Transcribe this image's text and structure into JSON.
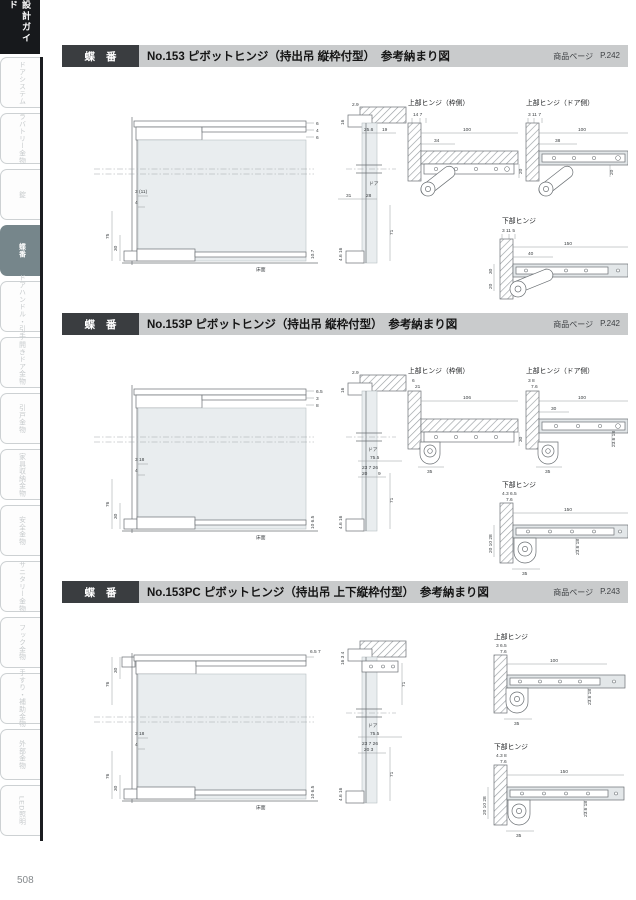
{
  "page": {
    "number": "508"
  },
  "sidebar": {
    "guide_tab": "設計ガイド",
    "tabs": [
      {
        "label": "ドアシステム",
        "active": false
      },
      {
        "label": "ラバトリー金物",
        "active": false
      },
      {
        "label": "錠",
        "active": false
      },
      {
        "label": "蝶番",
        "active": true
      },
      {
        "label": "ドアハンドル・引手",
        "active": false
      },
      {
        "label": "開きドア金物",
        "active": false
      },
      {
        "label": "引戸金物",
        "active": false
      },
      {
        "label": "家具収納金物",
        "active": false
      },
      {
        "label": "安全金物",
        "active": false
      },
      {
        "label": "サニタリー金物",
        "active": false
      },
      {
        "label": "フック金物",
        "active": false
      },
      {
        "label": "手すり・補助金物",
        "active": false
      },
      {
        "label": "外部金物",
        "active": false
      },
      {
        "label": "LED照明",
        "active": false
      }
    ]
  },
  "sections": [
    {
      "tag": "蝶 番",
      "title": "No.153 ピボットヒンジ（持出吊 縦枠付型）　参考納まり図",
      "product_page_label": "商品ページ",
      "product_page": "P.242",
      "labels": {
        "top_frame": "上部ヒンジ（枠側）",
        "top_door": "上部ヒンジ（ドア側）",
        "bottom": "下部ヒンジ",
        "floor": "床面",
        "door": "ドア"
      },
      "elev": {
        "t1": "6",
        "t2": "4",
        "t3": "6",
        "m1": "3 (11)",
        "m2": "4",
        "v1": "75",
        "v2": "30",
        "b1": "10.7"
      },
      "side": {
        "t1": "16",
        "t2": "2.9",
        "t3": "25.6",
        "t4": "19",
        "m1": "31",
        "m2": "28",
        "v1": "71",
        "b1": "4.6 16"
      },
      "d1": {
        "t": "14  7",
        "w": "100",
        "o": "34",
        "s": "20"
      },
      "d2": {
        "t": "3 11 7",
        "w": "100",
        "o": "38",
        "s": "20"
      },
      "d3": {
        "t": "3 11 5",
        "w": "150",
        "o": "40",
        "v1": "30",
        "v2": "20"
      }
    },
    {
      "tag": "蝶 番",
      "title": "No.153P ピボットヒンジ（持出吊 縦枠付型）　参考納まり図",
      "product_page_label": "商品ページ",
      "product_page": "P.242",
      "labels": {
        "top_frame": "上部ヒンジ（枠側）",
        "top_door": "上部ヒンジ（ドア側）",
        "bottom": "下部ヒンジ",
        "floor": "床面",
        "door": "ドア"
      },
      "elev": {
        "t1": "6.5",
        "t2": "3",
        "t3": "8",
        "m1": "3 18",
        "m2": "4",
        "v1": "76",
        "v2": "30",
        "b1": "10 6.5"
      },
      "side": {
        "t1": "16",
        "t2": "2.9",
        "t3": "75.5",
        "t4": "23 7 26",
        "m1": "20",
        "m2": "9",
        "v1": "71",
        "b1": "4.6 16"
      },
      "d1": {
        "t": "6",
        "t2": "21",
        "w": "106",
        "b": "35",
        "s": "30"
      },
      "d2": {
        "t": "3 8",
        "t2": "7.6",
        "w": "100",
        "o": "30",
        "r": "23.6 18",
        "b": "35"
      },
      "d3": {
        "t": "4.3 6.5",
        "t2": "7.6",
        "w": "150",
        "v": "20 10 28",
        "r": "23.6 18",
        "b": "35"
      }
    },
    {
      "tag": "蝶 番",
      "title": "No.153PC ピボットヒンジ（持出吊 上下縦枠付型）　参考納まり図",
      "product_page_label": "商品ページ",
      "product_page": "P.243",
      "labels": {
        "top": "上部ヒンジ",
        "bottom": "下部ヒンジ",
        "floor": "床面",
        "door": "ドア"
      },
      "elev": {
        "tv1": "30",
        "tv2": "76",
        "t1": "6.5 7",
        "m1": "3 18",
        "m2": "4",
        "v1": "76",
        "v2": "30",
        "b1": "10 6.5"
      },
      "side": {
        "t1": "16 3 4",
        "tv1": "71",
        "b1": "75.5",
        "b2": "23 7 26",
        "b3": "20 3",
        "v1": "71",
        "b4": "4.6 16"
      },
      "d1": {
        "t": "3 6.5",
        "t2": "7.6",
        "w": "100",
        "r": "23.6 18",
        "b": "35"
      },
      "d2": {
        "t": "4.3 8",
        "t2": "7.6",
        "w": "150",
        "v": "20 10 28",
        "r": "23.6 18",
        "b": "35"
      }
    }
  ]
}
